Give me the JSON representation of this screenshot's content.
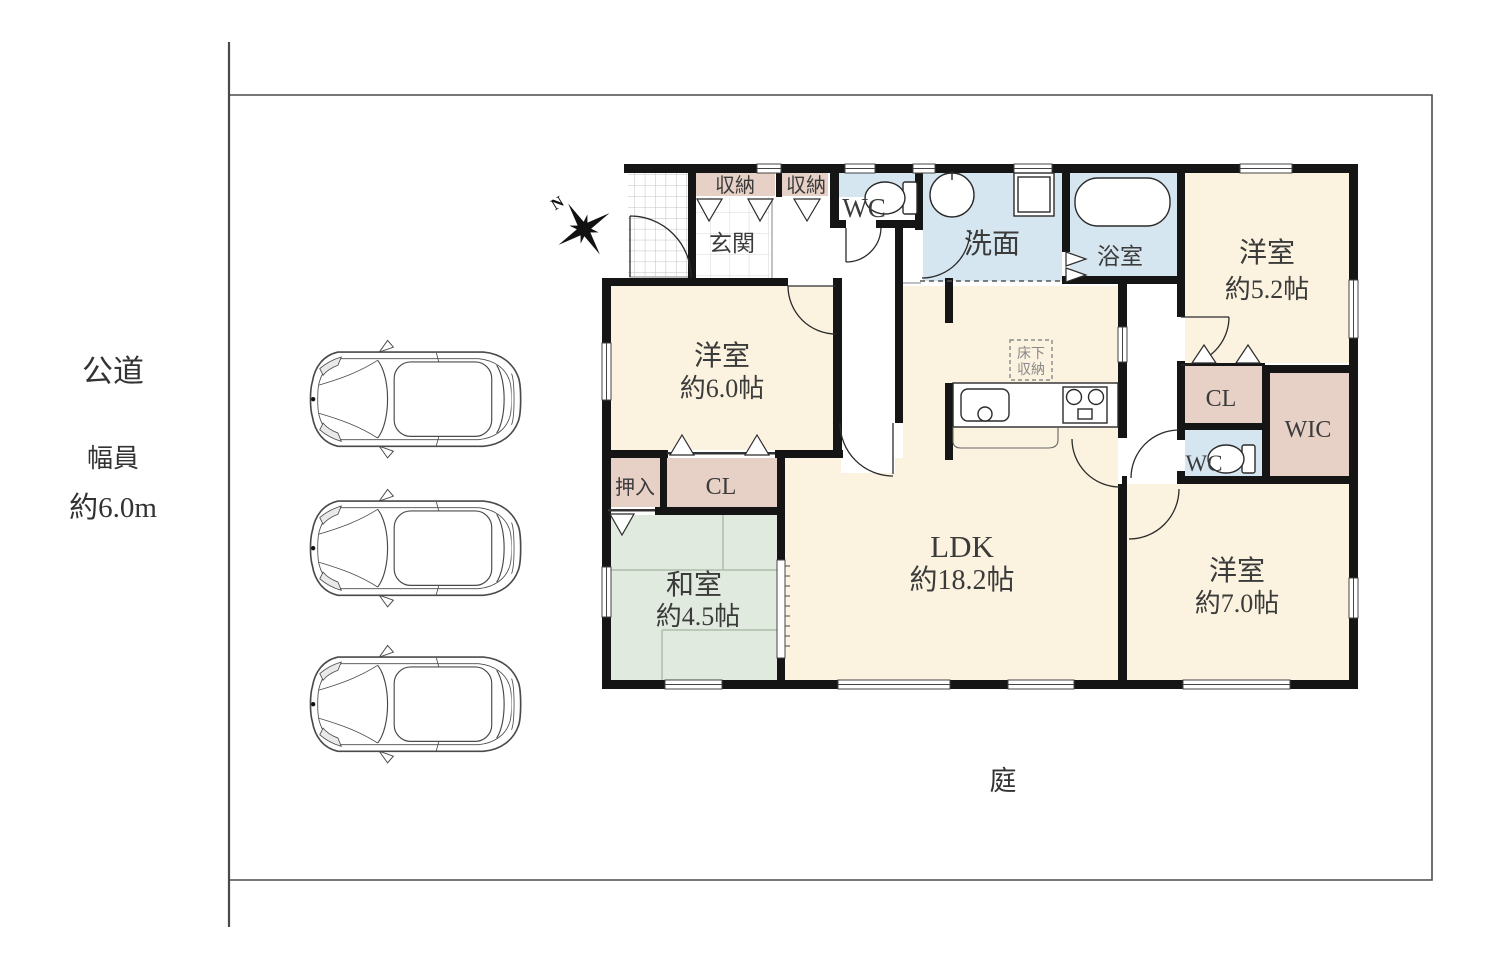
{
  "site": {
    "road_label": "公道",
    "road_width_label": "幅員",
    "road_width_value": "約6.0m",
    "garden_label": "庭",
    "compass_label": "N",
    "parking_car_count": 3
  },
  "rooms": {
    "entrance": {
      "label": "玄関"
    },
    "storage_a": {
      "label": "収納"
    },
    "storage_b": {
      "label": "収納"
    },
    "wc_north": {
      "label": "WC"
    },
    "washroom": {
      "label": "洗面"
    },
    "bathroom": {
      "label": "浴室"
    },
    "western_room_52": {
      "label": "洋室",
      "size": "約5.2帖"
    },
    "closet_north": {
      "label": "CL"
    },
    "walk_in_closet": {
      "label": "WIC"
    },
    "wc_south": {
      "label": "WC"
    },
    "western_room_70": {
      "label": "洋室",
      "size": "約7.0帖"
    },
    "western_room_60": {
      "label": "洋室",
      "size": "約6.0帖"
    },
    "oshiire": {
      "label": "押入"
    },
    "closet_south": {
      "label": "CL"
    },
    "japanese_room": {
      "label": "和室",
      "size": "約4.5帖"
    },
    "ldk": {
      "label": "LDK",
      "size": "約18.2帖"
    },
    "underfloor_storage": {
      "label_line1": "床下",
      "label_line2": "収納"
    }
  },
  "colors": {
    "wall": "#151515",
    "room_cream": "#fbf2df",
    "room_tan": "#e7d0c5",
    "room_blue": "#d5e6f0",
    "room_green": "#e0eade",
    "boundary_line": "#4a4a4a"
  }
}
